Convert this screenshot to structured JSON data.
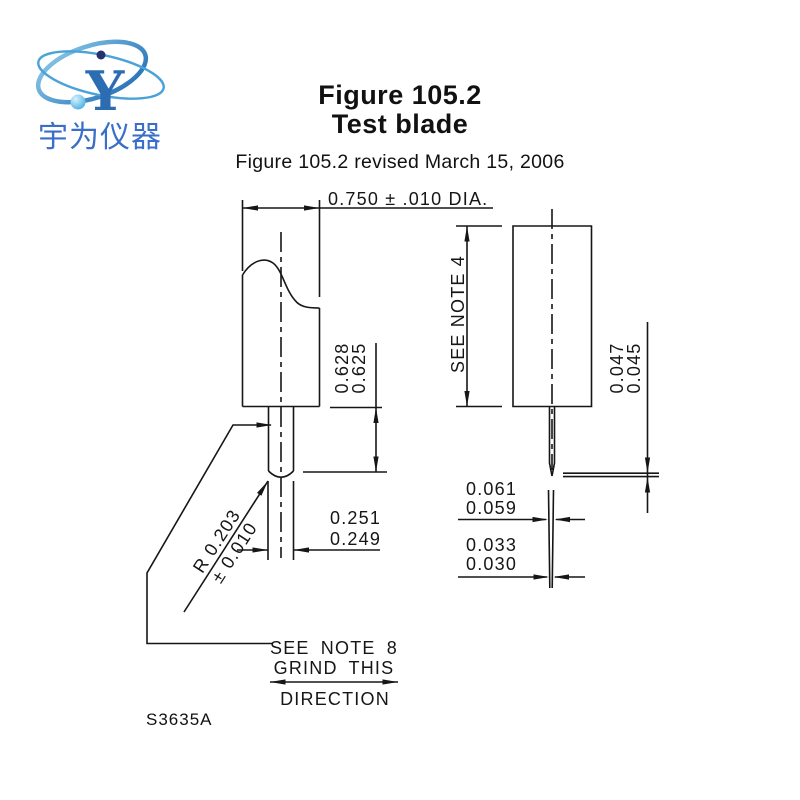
{
  "logo": {
    "symbol": "Y",
    "company_name": "宇为仪器"
  },
  "header": {
    "title": "Figure 105.2",
    "subtitle": "Test blade",
    "revision": "Figure 105.2 revised March 15, 2006"
  },
  "drawing": {
    "front_view": {
      "diameter_dim": "0.750 ± .010 DIA.",
      "blade_length": {
        "max": "0.628",
        "min": "0.625"
      },
      "blade_width": {
        "max": "0.251",
        "min": "0.249"
      },
      "tip_radius": {
        "value": "R 0.203",
        "tolerance": "± 0.010"
      }
    },
    "side_view": {
      "shank_note": "SEE NOTE 4",
      "tip_thickness": {
        "max": "0.047",
        "min": "0.045"
      },
      "edge_width_upper": {
        "max": "0.061",
        "min": "0.059"
      },
      "edge_width_lower": {
        "max": "0.033",
        "min": "0.030"
      }
    },
    "grind_note": {
      "line1": "SEE NOTE 8",
      "line2": "GRIND THIS",
      "line3": "DIRECTION"
    },
    "drawing_number": "S3635A"
  },
  "colors": {
    "line": "#161616",
    "logo_orbit_blue": "#2e86c8",
    "logo_text_blue": "#3a6fc9",
    "logo_navy": "#26316f",
    "logo_light_blue": "#35a8e0"
  }
}
